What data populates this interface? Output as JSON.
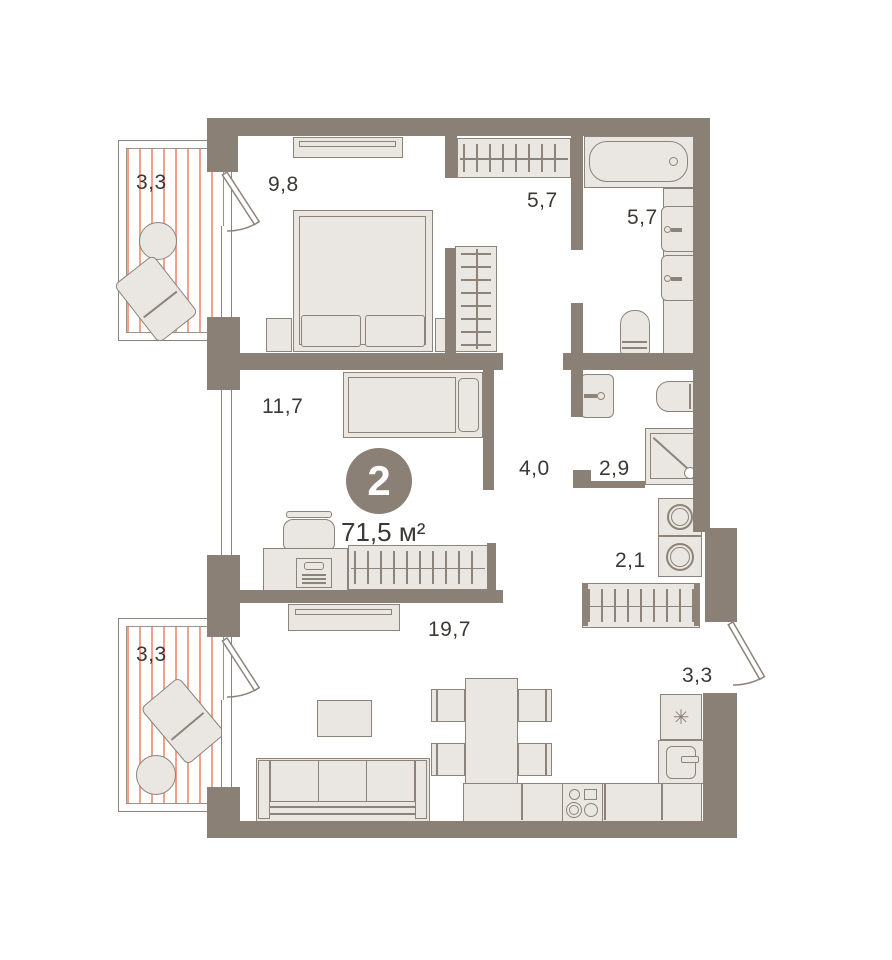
{
  "plan": {
    "badge": "2",
    "total_area": "71,5 м²",
    "fridge_icon": "✳",
    "rooms": [
      {
        "id": "balcony-top",
        "area": "3,3"
      },
      {
        "id": "bedroom",
        "area": "9,8"
      },
      {
        "id": "wardrobe-room",
        "area": "5,7"
      },
      {
        "id": "bathroom-main",
        "area": "5,7"
      },
      {
        "id": "bedroom-2",
        "area": "11,7"
      },
      {
        "id": "hallway",
        "area": "4,0"
      },
      {
        "id": "bathroom-guest",
        "area": "2,9"
      },
      {
        "id": "laundry",
        "area": "2,1"
      },
      {
        "id": "living-kitchen",
        "area": "19,7"
      },
      {
        "id": "balcony-bottom",
        "area": "3,3"
      },
      {
        "id": "balcony-right",
        "area": "3,3"
      }
    ]
  },
  "colors": {
    "wall": "#8a8076",
    "furniture_fill": "#eae7e2",
    "outline": "#8d8379",
    "balcony_stripe": "#efa28c",
    "text": "#3c3835",
    "badge_bg": "#8a8076",
    "badge_text": "#ffffff"
  }
}
